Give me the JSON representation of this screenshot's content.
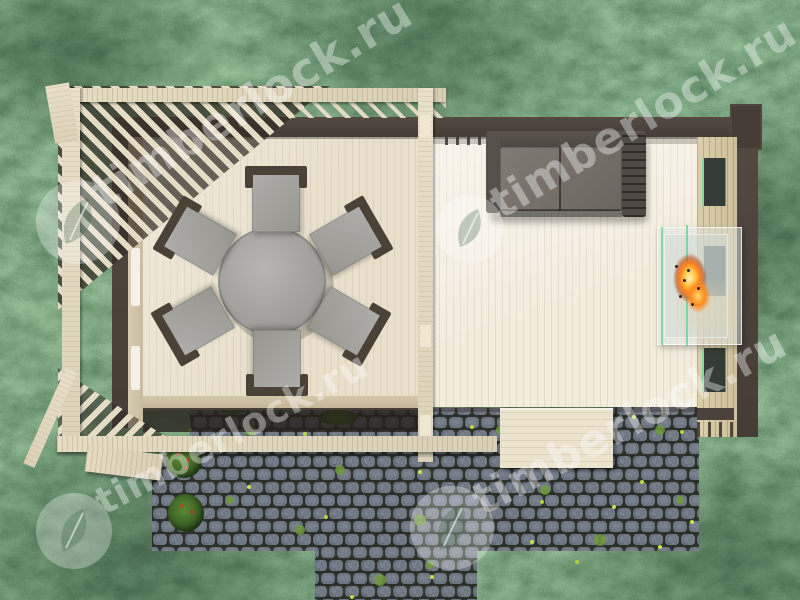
{
  "watermark": {
    "text": "timberlock.ru",
    "logo_icon": "leaf-badge-icon",
    "color": "#ffffff",
    "opacity": 0.38,
    "instances": 4
  },
  "scene": {
    "view": "top-down render",
    "subject": "wooden garden house with open pergola terrace",
    "furniture": {
      "round_table": 1,
      "chairs": 6,
      "sofa": 1,
      "glass_fireplace": 1
    },
    "ground": [
      "grass lawn",
      "cobblestone patio",
      "wooden landing step"
    ]
  },
  "colors": {
    "grass_green": "#4e7b54",
    "deck_wood": "#e5dcc6",
    "room_floor": "#f1ebdc",
    "wall_brown": "#4a423b",
    "stone_gray": "#828c9a",
    "stone_gap": "#343a32",
    "table_gray": "#a5a4a0",
    "sofa_gray": "#6e6861",
    "flame_orange": "#ff8a1f",
    "glass_green": "#8fd4a6",
    "moss_green": "#6f9a3a"
  }
}
